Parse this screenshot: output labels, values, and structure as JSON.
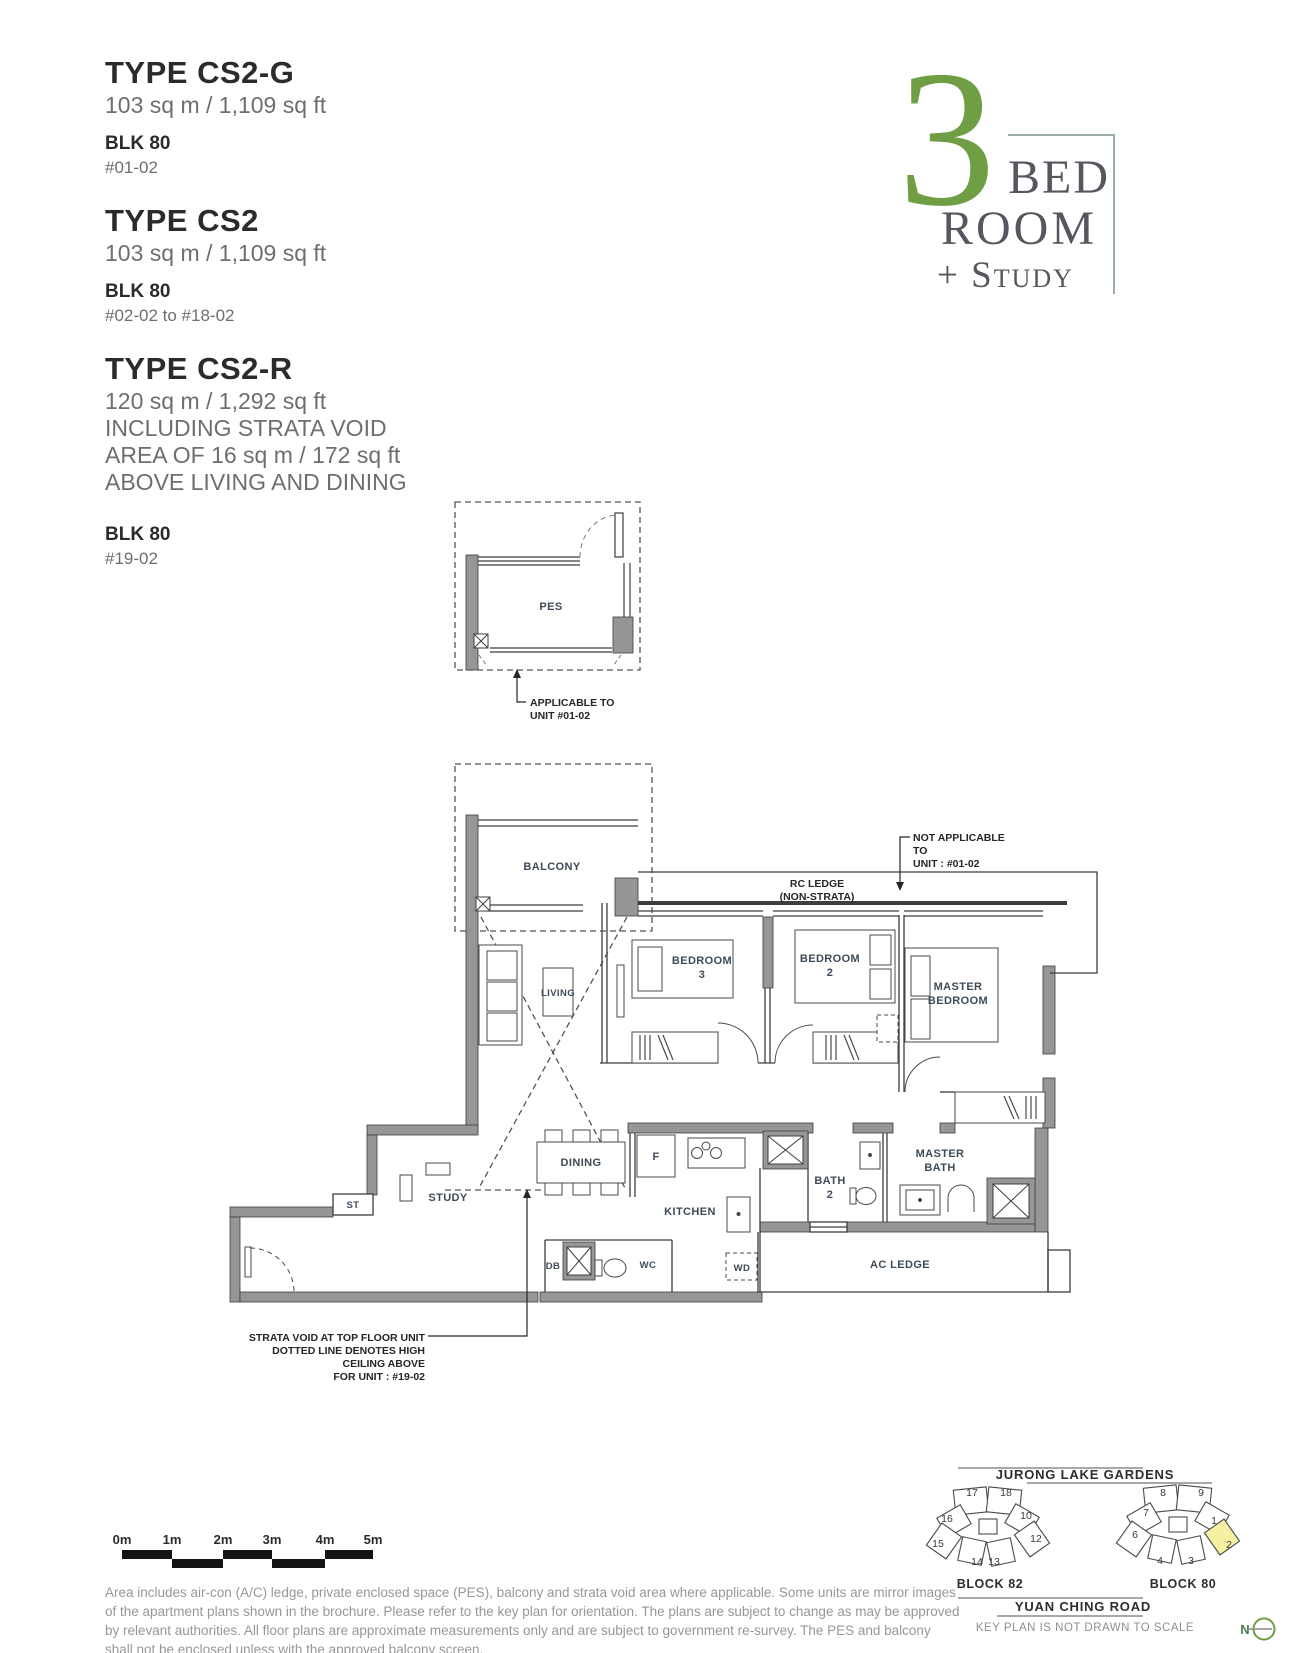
{
  "unit_types": [
    {
      "type_label": "TYPE CS2-G",
      "area": "103 sq m / 1,109 sq ft",
      "block": "BLK 80",
      "units": "#01-02"
    },
    {
      "type_label": "TYPE CS2",
      "area": "103 sq m / 1,109 sq ft",
      "block": "BLK 80",
      "units": "#02-02 to #18-02"
    },
    {
      "type_label": "TYPE CS2-R",
      "area": "120 sq m / 1,292 sq ft",
      "note_l1": "INCLUDING STRATA VOID",
      "note_l2": "AREA OF 16 sq m / 172 sq ft",
      "note_l3": "ABOVE LIVING AND DINING",
      "block": "BLK 80",
      "units": "#19-02"
    }
  ],
  "badge": {
    "number": "3",
    "word1": "BED",
    "word2": "ROOM",
    "word3": "+ Study",
    "number_color": "#6f9e44",
    "text_color": "#56565e",
    "line_color": "#9badab"
  },
  "pes": {
    "room": "PES",
    "note_l1": "APPLICABLE TO",
    "note_l2": "UNIT #01-02"
  },
  "plan": {
    "rooms": {
      "balcony": "BALCONY",
      "living": "LIVING",
      "bedroom3_l1": "BEDROOM",
      "bedroom3_l2": "3",
      "bedroom2_l1": "BEDROOM",
      "bedroom2_l2": "2",
      "master_l1": "MASTER",
      "master_l2": "BEDROOM",
      "dining": "DINING",
      "study": "STUDY",
      "st": "ST",
      "kitchen": "KITCHEN",
      "bath2_l1": "BATH",
      "bath2_l2": "2",
      "mbath_l1": "MASTER",
      "mbath_l2": "BATH",
      "ac_ledge": "AC LEDGE",
      "wc": "WC",
      "db": "DB",
      "wd": "WD",
      "fridge": "F"
    },
    "annotations": {
      "rc1": "RC LEDGE",
      "rc2": "(NON-STRATA)",
      "na1": "NOT APPLICABLE",
      "na2": "TO",
      "na3": "UNIT : #01-02",
      "sv1": "STRATA VOID AT TOP FLOOR UNIT",
      "sv2": "DOTTED LINE DENOTES HIGH",
      "sv3": "CEILING ABOVE",
      "sv4": "FOR UNIT : #19-02"
    },
    "wall_color": "#969696"
  },
  "scale_bar": {
    "labels": [
      "0m",
      "1m",
      "2m",
      "3m",
      "4m",
      "5m"
    ]
  },
  "disclaimer_lines": [
    "Area includes air-con (A/C) ledge, private enclosed space (PES), balcony and strata void area where applicable. Some units are mirror images",
    "of the apartment plans shown in the brochure. Please refer to the key plan for orientation. The plans are subject to change as may be approved",
    "by relevant authorities. All floor plans are approximate measurements only and are subject to government re-survey. The PES and balcony",
    "shall not be enclosed unless with the approved balcony screen."
  ],
  "key_plan": {
    "top_road": "JURONG LAKE GARDENS",
    "bottom_road": "YUAN CHING ROAD",
    "note": "KEY PLAN IS NOT DRAWN TO SCALE",
    "compass": "N",
    "highlight_color": "#f6f0a2",
    "blocks": [
      {
        "name": "BLOCK 82",
        "units": [
          "17",
          "18",
          "16",
          "10",
          "15",
          "12",
          "14",
          "13"
        ]
      },
      {
        "name": "BLOCK 80",
        "units": [
          "8",
          "9",
          "7",
          "1",
          "6",
          "2",
          "4",
          "3"
        ],
        "highlighted_unit": "2"
      }
    ]
  }
}
